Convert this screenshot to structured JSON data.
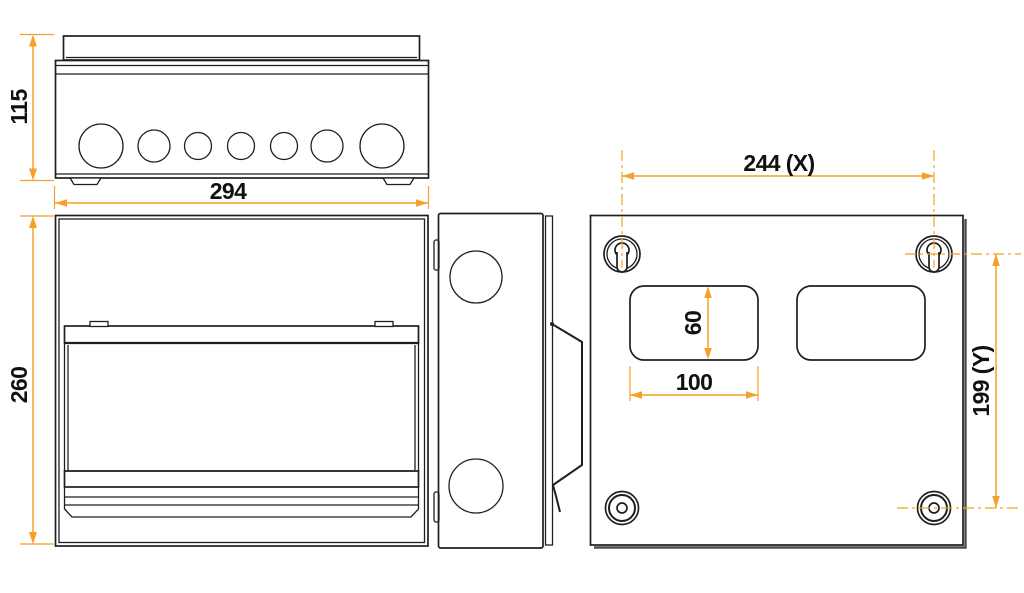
{
  "colors": {
    "line": "#1f1f1f",
    "dimension": "#f5a028",
    "text": "#111111",
    "shadow": "#4d4d4d",
    "background": "#ffffff"
  },
  "dims": {
    "top_height": "115",
    "top_width": "294",
    "front_height": "260",
    "hole_spacing_x": "244 (X)",
    "hole_spacing_y": "199 (Y)",
    "cutout_height": "60",
    "cutout_width": "100"
  }
}
